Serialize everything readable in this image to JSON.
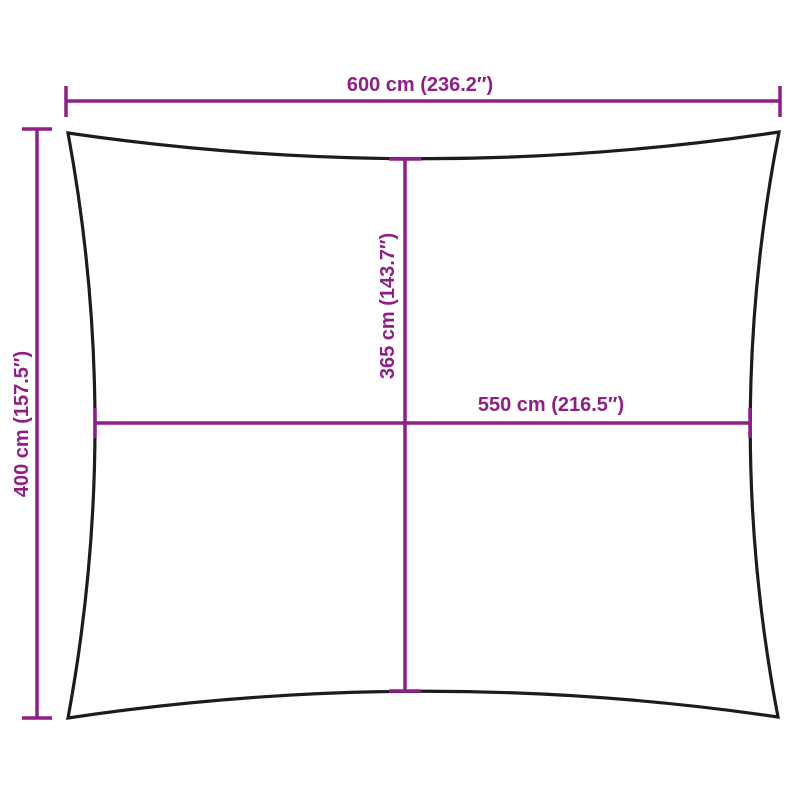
{
  "colors": {
    "dimension": "#8E1F87",
    "outline": "#1C1C1C",
    "background": "#FFFFFF"
  },
  "labels": {
    "top_width": "600 cm (236.2″)",
    "left_height": "400 cm (157.5″)",
    "inner_height": "365 cm (143.7″)",
    "inner_width": "550 cm (216.5″)"
  }
}
